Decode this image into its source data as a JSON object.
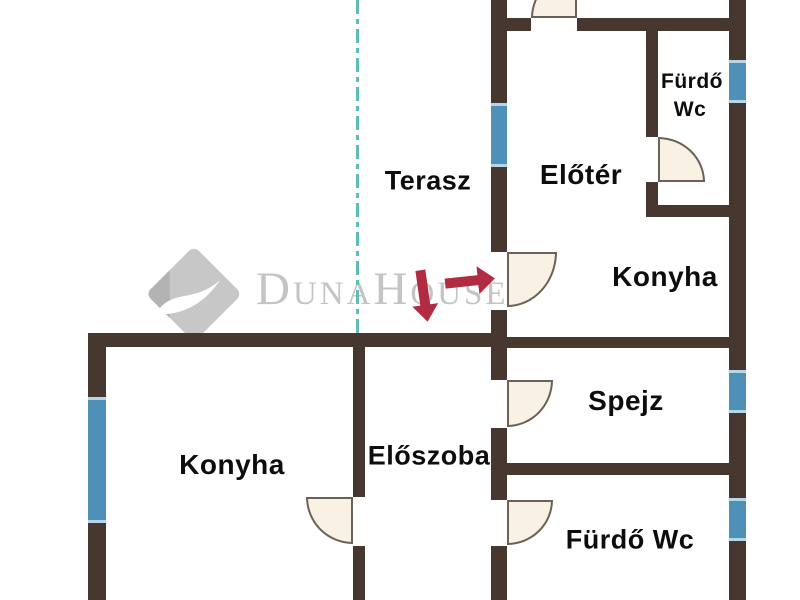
{
  "watermark": {
    "brand_text": "DunaHouse",
    "logo_icon": "duna-house-diamond-wave-logo"
  },
  "colors": {
    "background": "#ffffff",
    "wall": "#46382e",
    "window": "#4e90b8",
    "window_edge": "#b5d6e6",
    "door_fill": "#f8f1e4",
    "door_edge": "#6b6156",
    "boundary_line": "#5fbdb4",
    "arrow": "#b12c42",
    "label": "#0d0d0d",
    "watermark_text": "#c4c4c4",
    "watermark_logo": "#c7c7c7",
    "watermark_logo_dark": "#b3b3b3"
  },
  "rooms": [
    {
      "name": "terasz",
      "label": "Terasz",
      "x": 428,
      "y": 181,
      "size": 27
    },
    {
      "name": "eloter",
      "label": "Előtér",
      "x": 581,
      "y": 175,
      "size": 28
    },
    {
      "name": "furdo-wc-top-1",
      "label": "Fürdő",
      "x": 692,
      "y": 82,
      "size": 21
    },
    {
      "name": "furdo-wc-top-2",
      "label": "Wc",
      "x": 690,
      "y": 110,
      "size": 21
    },
    {
      "name": "konyha-top",
      "label": "Konyha",
      "x": 665,
      "y": 277,
      "size": 28
    },
    {
      "name": "spejz",
      "label": "Spejz",
      "x": 626,
      "y": 401,
      "size": 28
    },
    {
      "name": "eloszoba",
      "label": "Előszoba",
      "x": 429,
      "y": 456,
      "size": 27
    },
    {
      "name": "konyha-left",
      "label": "Konyha",
      "x": 232,
      "y": 465,
      "size": 28
    },
    {
      "name": "furdo-wc-bottom",
      "label": "Fürdő Wc",
      "x": 630,
      "y": 540,
      "size": 27
    }
  ],
  "floorplan": {
    "walls": [
      {
        "x": 491,
        "y": 0,
        "w": 16,
        "h": 103
      },
      {
        "x": 491,
        "y": 161,
        "w": 16,
        "h": 91
      },
      {
        "x": 491,
        "y": 310,
        "w": 16,
        "h": 70
      },
      {
        "x": 491,
        "y": 428,
        "w": 16,
        "h": 72
      },
      {
        "x": 491,
        "y": 546,
        "w": 16,
        "h": 54
      },
      {
        "x": 497,
        "y": 18,
        "w": 34,
        "h": 13
      },
      {
        "x": 577,
        "y": 18,
        "w": 169,
        "h": 13
      },
      {
        "x": 729,
        "y": 0,
        "w": 17,
        "h": 60
      },
      {
        "x": 729,
        "y": 97,
        "w": 17,
        "h": 273
      },
      {
        "x": 729,
        "y": 407,
        "w": 17,
        "h": 91
      },
      {
        "x": 729,
        "y": 535,
        "w": 17,
        "h": 65
      },
      {
        "x": 646,
        "y": 22,
        "w": 12,
        "h": 115
      },
      {
        "x": 646,
        "y": 182,
        "w": 12,
        "h": 32
      },
      {
        "x": 646,
        "y": 205,
        "w": 90,
        "h": 12
      },
      {
        "x": 497,
        "y": 337,
        "w": 249,
        "h": 11
      },
      {
        "x": 88,
        "y": 333,
        "w": 419,
        "h": 14
      },
      {
        "x": 88,
        "y": 333,
        "w": 18,
        "h": 64
      },
      {
        "x": 88,
        "y": 517,
        "w": 18,
        "h": 83
      },
      {
        "x": 353,
        "y": 333,
        "w": 12,
        "h": 164
      },
      {
        "x": 353,
        "y": 546,
        "w": 12,
        "h": 54
      },
      {
        "x": 497,
        "y": 463,
        "w": 249,
        "h": 12
      }
    ],
    "windows": [
      {
        "x": 491,
        "y": 103,
        "w": 16,
        "h": 58
      },
      {
        "x": 729,
        "y": 60,
        "w": 17,
        "h": 37
      },
      {
        "x": 729,
        "y": 370,
        "w": 17,
        "h": 37
      },
      {
        "x": 729,
        "y": 498,
        "w": 17,
        "h": 37
      },
      {
        "x": 88,
        "y": 397,
        "w": 18,
        "h": 120
      }
    ],
    "doors": [
      {
        "name": "door-arc-entrance-top",
        "x": 531,
        "y": -28,
        "w": 46,
        "h": 46,
        "square_corner": "bottom-right"
      },
      {
        "name": "door-arc-terasz-eloter",
        "x": 507,
        "y": 252,
        "w": 50,
        "h": 55,
        "square_corner": "top-left"
      },
      {
        "name": "door-arc-spejz",
        "x": 507,
        "y": 380,
        "w": 46,
        "h": 47,
        "square_corner": "top-left"
      },
      {
        "name": "door-arc-furdo-bottom",
        "x": 507,
        "y": 500,
        "w": 46,
        "h": 45,
        "square_corner": "top-left"
      },
      {
        "name": "door-arc-konyha-left",
        "x": 306,
        "y": 497,
        "w": 47,
        "h": 47,
        "square_corner": "top-right"
      },
      {
        "name": "door-arc-furdo-top",
        "x": 658,
        "y": 137,
        "w": 47,
        "h": 45,
        "square_corner": "bottom-left"
      }
    ],
    "boundary_lines": [
      {
        "name": "property-boundary-dashed-line",
        "x": 356,
        "y": 0,
        "w": 3,
        "h": 333
      }
    ],
    "arrows": [
      {
        "name": "entrance-arrow-down",
        "direction": "down",
        "x": 411,
        "y": 270,
        "length": 52,
        "thickness": 10,
        "head": 17,
        "width": 26,
        "rotate": -8
      },
      {
        "name": "entrance-arrow-right",
        "direction": "right",
        "x": 445,
        "y": 267,
        "length": 50,
        "thickness": 10,
        "head": 17,
        "width": 28,
        "rotate": -6
      }
    ]
  }
}
